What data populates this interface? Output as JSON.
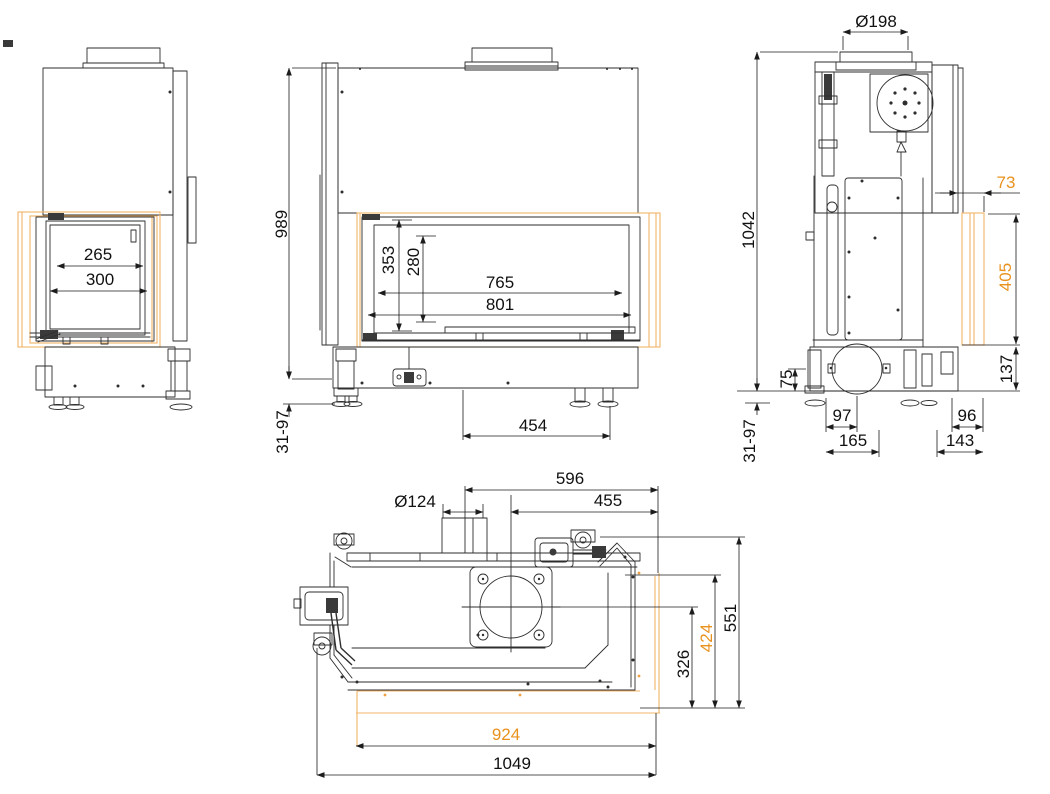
{
  "colors": {
    "line": "#2e2e2e",
    "dimension_text": "#111111",
    "accent_text": "#e8921e",
    "accent_line": "#f2b469"
  },
  "views": {
    "left_side": {
      "dims": {
        "glass_width": "265",
        "frame_width": "300"
      }
    },
    "front": {
      "dims": {
        "total_height": "989",
        "leg_range": "31-97",
        "door_height": "353",
        "glass_height": "280",
        "glass_width": "765",
        "door_width": "801",
        "foot_offset": "454"
      }
    },
    "right_side": {
      "dims": {
        "flue_diameter": "Ø198",
        "total_height": "1042",
        "leg_range": "31-97",
        "glass_offset": "73",
        "side_glass_height": "405",
        "base_height": "137",
        "intake_height": "75",
        "intake_offset": "97",
        "intake_spacing": "165",
        "rear_offset": "96",
        "rear_spacing": "143"
      }
    },
    "top": {
      "dims": {
        "flue_to_back": "596",
        "flue_to_right": "455",
        "intake_diameter": "Ø124",
        "total_depth": "551",
        "glass_depth": "424",
        "flue_center_depth": "326",
        "glass_width": "924",
        "total_width": "1049"
      }
    }
  }
}
